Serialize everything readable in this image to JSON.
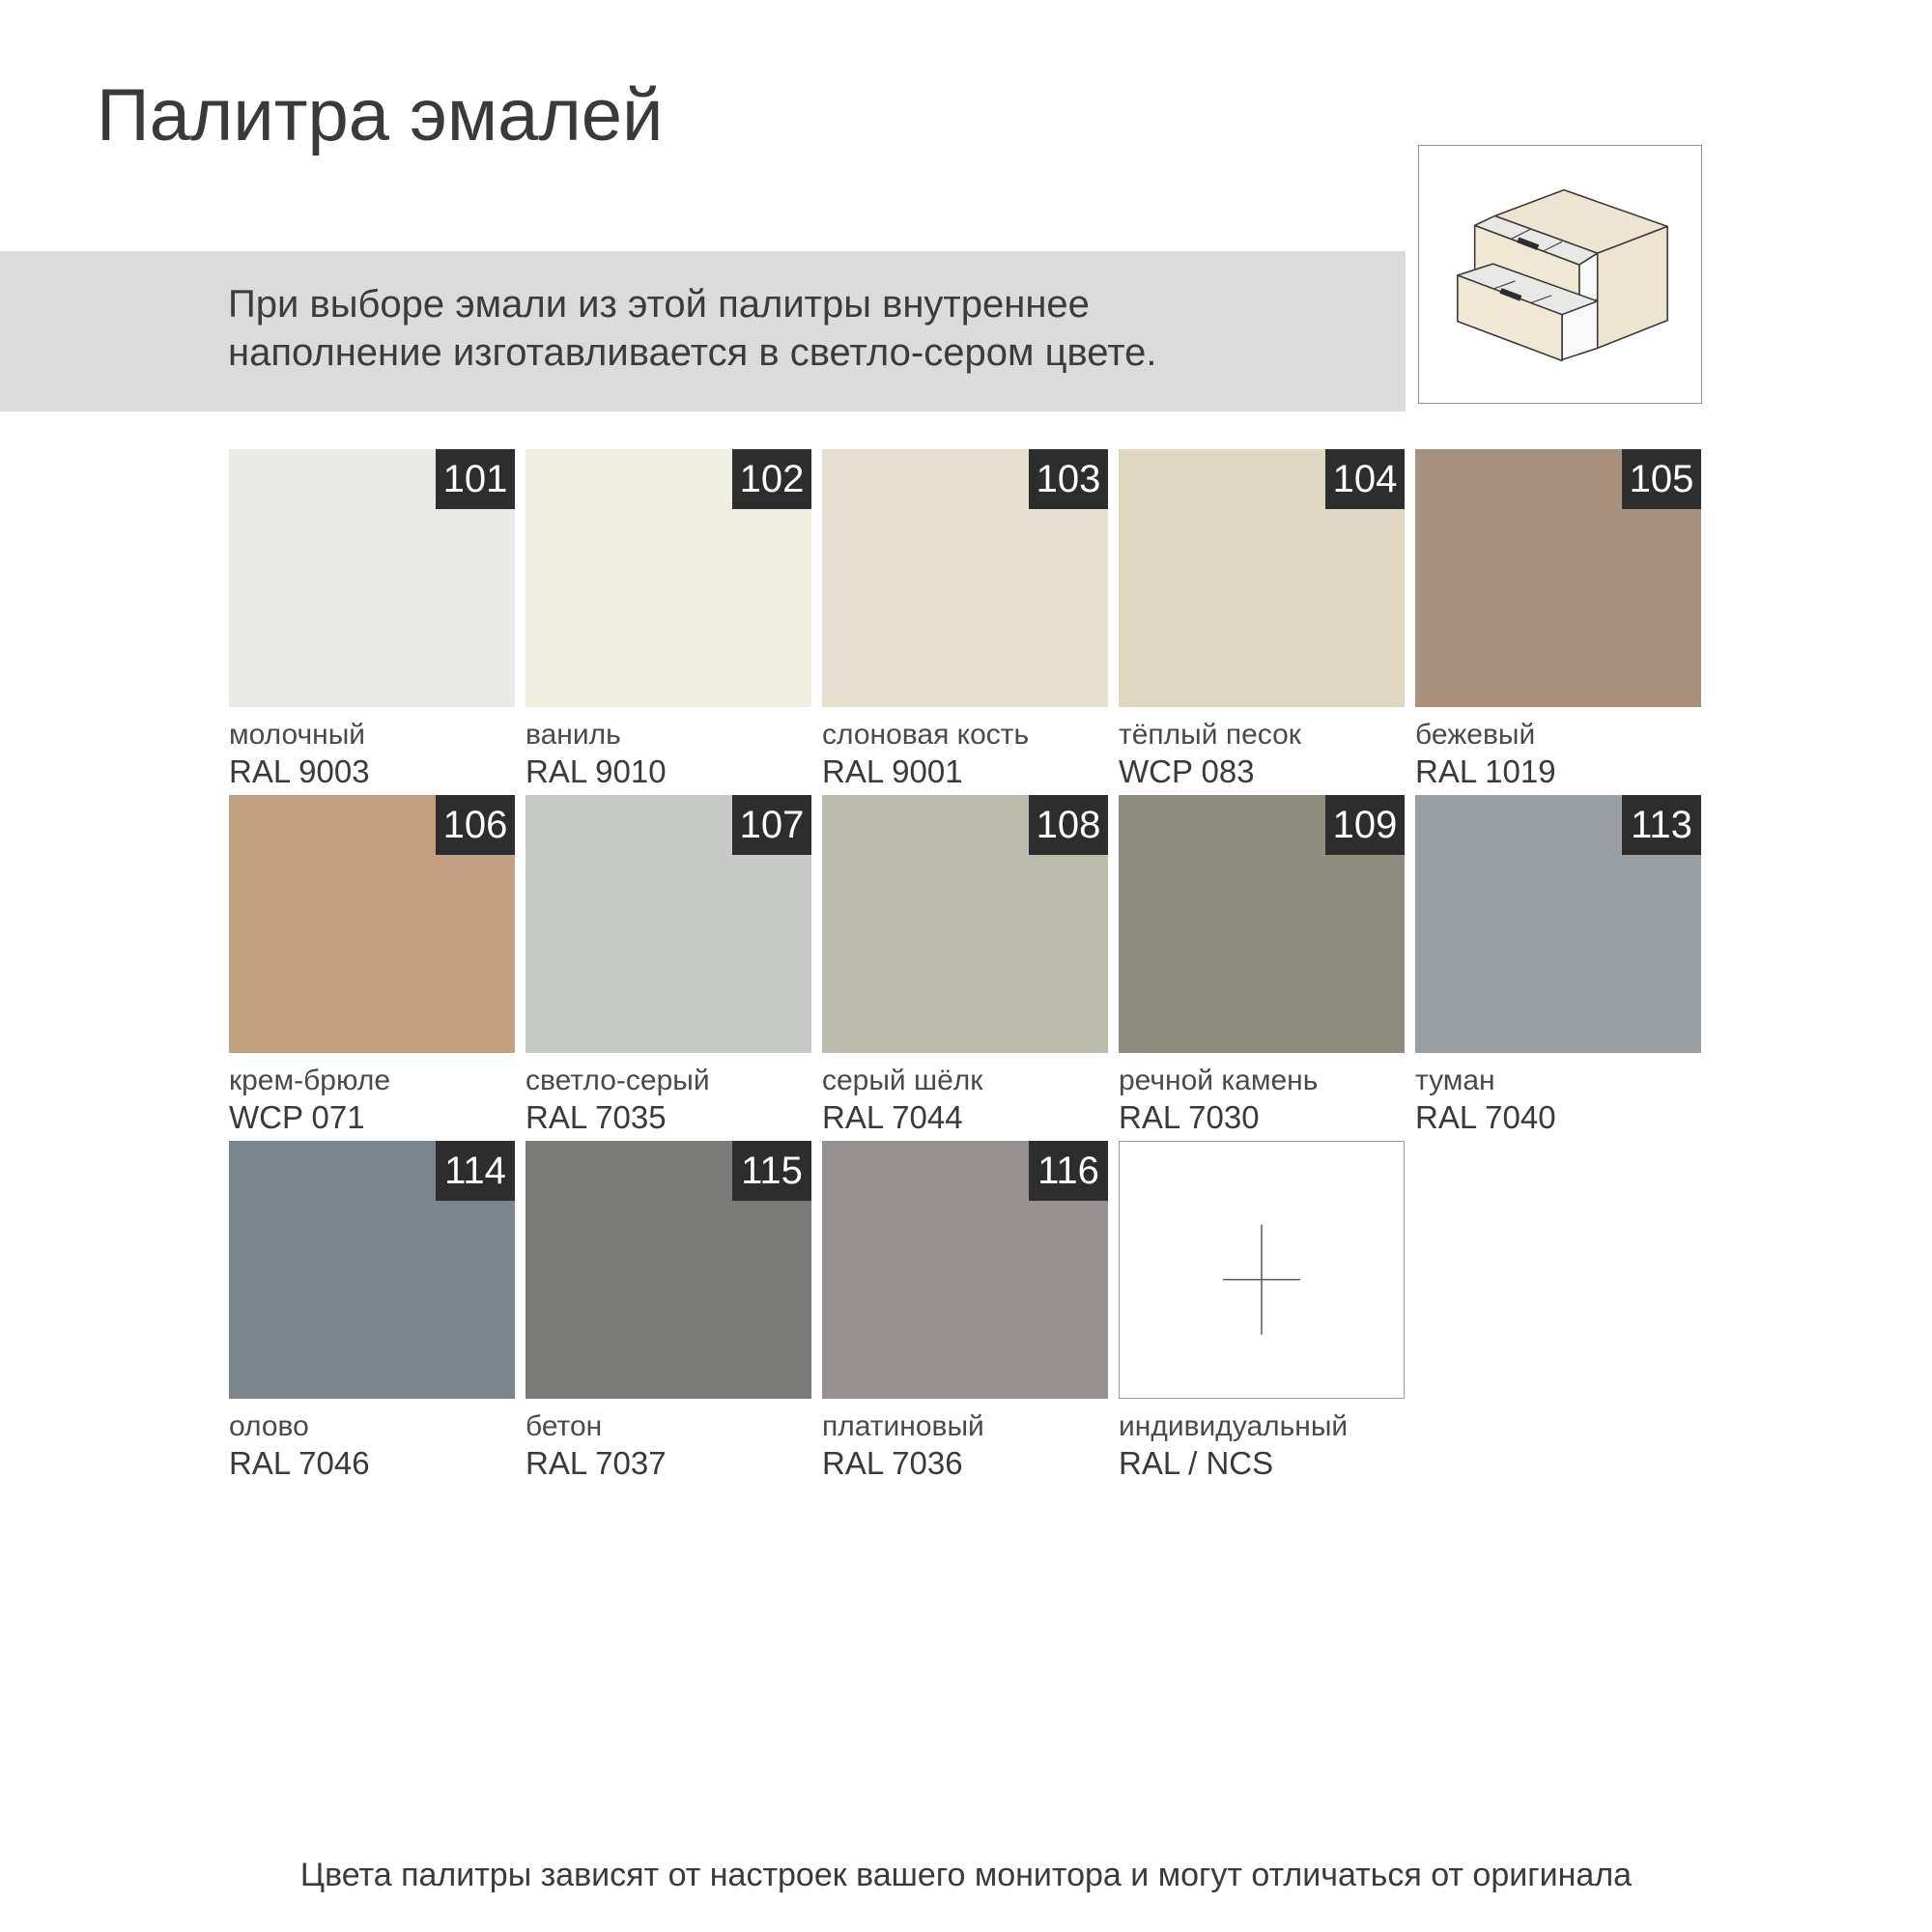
{
  "page": {
    "title": "Палитра эмалей",
    "note_line1": "При выборе эмали из этой палитры внутреннее",
    "note_line2": "наполнение изготавливается в светло-сером цвете.",
    "footer": "Цвета палитры зависят от настроек вашего монитора и могут отличаться от оригинала"
  },
  "theme": {
    "banner_bg": "#dbdbdb",
    "badge_bg": "#2d2d2d",
    "badge_text": "#ffffff",
    "text": "#3a3a3a",
    "custom_swatch_border": "#9b9b9b",
    "custom_cross": "#5a5a5a",
    "illustration_border": "#8f8f8f",
    "illustration_wood": "#efe6d4",
    "illustration_interior": "#e8e8e6"
  },
  "illustration": {
    "icon": "two-drawer-cabinet"
  },
  "swatches": [
    {
      "num": "101",
      "name": "молочный",
      "code": "RAL 9003",
      "color": "#e9e9e5"
    },
    {
      "num": "102",
      "name": "ваниль",
      "code": "RAL 9010",
      "color": "#f0ede1"
    },
    {
      "num": "103",
      "name": "слоновая кость",
      "code": "RAL 9001",
      "color": "#e8e0cf"
    },
    {
      "num": "104",
      "name": "тёплый песок",
      "code": "WCP 083",
      "color": "#e0d7c2"
    },
    {
      "num": "105",
      "name": "бежевый",
      "code": "RAL 1019",
      "color": "#a8907c"
    },
    {
      "num": "106",
      "name": "крем-брюле",
      "code": "WCP 071",
      "color": "#c1a084"
    },
    {
      "num": "107",
      "name": "светло-серый",
      "code": "RAL 7035",
      "color": "#c6c9c6"
    },
    {
      "num": "108",
      "name": "серый шёлк",
      "code": "RAL 7044",
      "color": "#bbbcae"
    },
    {
      "num": "109",
      "name": "речной камень",
      "code": "RAL 7030",
      "color": "#8f8d80"
    },
    {
      "num": "113",
      "name": "туман",
      "code": "RAL 7040",
      "color": "#999fa3"
    },
    {
      "num": "114",
      "name": "олово",
      "code": "RAL 7046",
      "color": "#7c848c"
    },
    {
      "num": "115",
      "name": "бетон",
      "code": "RAL 7037",
      "color": "#7b7b7a"
    },
    {
      "num": "116",
      "name": "платиновый",
      "code": "RAL 7036",
      "color": "#969190"
    },
    {
      "num": "",
      "name": "индивидуальный",
      "code": "RAL / NCS",
      "color": "#ffffff",
      "custom": true
    }
  ]
}
